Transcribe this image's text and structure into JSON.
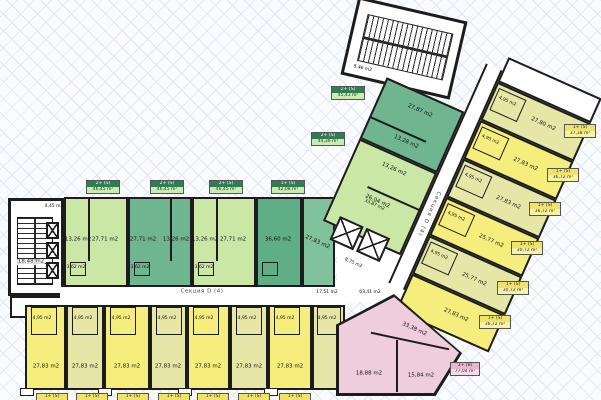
{
  "colors": {
    "wall": "#1c1c1c",
    "green_light": "#cbe7a6",
    "green_medium": "#6fb58f",
    "green_dark": "#5fae85",
    "yellow_bright": "#f6ee7c",
    "yellow_pale": "#e6e7a6",
    "pink": "#eecddc",
    "badge_green": "#2f7d52",
    "badge_yellow": "#efe46a",
    "badge_pink": "#e7b6d1"
  },
  "left_wing": {
    "stair": {
      "area": "18,48 m2",
      "vestibule": "4,45 m2"
    },
    "green_units": [
      {
        "room_a": "13,26 m2",
        "room_b": "27,71 m2",
        "bath": "3,62 m2"
      },
      {
        "room_a": "27,71 m2",
        "room_b": "13,26 m2",
        "bath": "3,62 m2"
      },
      {
        "room_a": "13,26 m2",
        "room_b": "27,71 m2",
        "bath": "3,62 m2"
      },
      {
        "room_a": "36,60 m2"
      },
      {
        "room_a": "27,83 m2"
      }
    ],
    "corridor": {
      "label": "Секция D (4)",
      "area_left": "17,51 m2",
      "area_right": "63,41 m2"
    },
    "yellow_units": [
      {
        "main": "27,83 m2",
        "bath": "4,95 m2"
      },
      {
        "main": "27,83 m2",
        "bath": "4,95 m2"
      },
      {
        "main": "27,83 m2",
        "bath": "4,95 m2"
      },
      {
        "main": "27,83 m2",
        "bath": "4,95 m2"
      },
      {
        "main": "27,83 m2",
        "bath": "4,95 m2"
      },
      {
        "main": "27,83 m2",
        "bath": "4,95 m2"
      },
      {
        "main": "27,83 m2",
        "bath": "4,95 m2"
      },
      {
        "bath": "4,95 m2"
      }
    ]
  },
  "diagonal_wing": {
    "stair_area": "5,46 m2",
    "hall_area": "33,87 m2",
    "lift_area": "8,75 m2",
    "corridor_label": "Секция D (4)",
    "green_units": [
      {
        "room_a": "27,87 m2",
        "room_b": "13,28 m2"
      },
      {
        "room_a": "13,26 m2",
        "room_b": "26,04 m2"
      }
    ],
    "yellow_units": [
      {
        "main": "27,80 m2",
        "bath": "4,95 m2"
      },
      {
        "main": "27,83 m2",
        "bath": "4,95 m2"
      },
      {
        "main": "27,83 m2",
        "bath": "4,95 m2"
      },
      {
        "main": "25,77 m2",
        "bath": "4,95 m2"
      },
      {
        "main": "25,77 m2",
        "bath": "4,95 m2"
      },
      {
        "main": "27,83 m2"
      }
    ],
    "pink_unit": {
      "room_a": "33,38 m2",
      "room_b": "18,88 m2",
      "room_c": "15,84 m2"
    }
  },
  "badges": {
    "top": [
      {
        "type": "2+ (S)",
        "area": "46,45 m²"
      },
      {
        "type": "2+ (S)",
        "area": "46,45 m²"
      },
      {
        "type": "2+ (S)",
        "area": "46,45 m²"
      },
      {
        "type": "1+ (S)",
        "area": "42,08 m²"
      }
    ],
    "left": [
      {
        "type": "2+ (S)",
        "area": "45,43 m²"
      },
      {
        "type": "2+ (S)",
        "area": "44,36 m²"
      }
    ],
    "right": [
      {
        "type": "1+ (S)",
        "area": "37,38 m²"
      },
      {
        "type": "1+ (S)",
        "area": "36,72 m²"
      },
      {
        "type": "1+ (S)",
        "area": "36,72 m²"
      },
      {
        "type": "1+ (S)",
        "area": "30,72 m²"
      },
      {
        "type": "1+ (S)",
        "area": "30,72 m²"
      },
      {
        "type": "1+ (S)",
        "area": "36,72 m²"
      }
    ],
    "pink": {
      "type": "3+ (B)",
      "area": "77,04 m²"
    },
    "bottom": [
      {
        "type": "1+ (S)",
        "area": "36,72 m²"
      },
      {
        "type": "1+ (S)",
        "area": "36,72 m²"
      },
      {
        "type": "1+ (S)",
        "area": "36,72 m²"
      },
      {
        "type": "1+ (S)",
        "area": "36,72 m²"
      },
      {
        "type": "1+ (S)",
        "area": "36,72 m²"
      },
      {
        "type": "1+ (S)",
        "area": "36,72 m²"
      },
      {
        "type": "1+ (S)",
        "area": "36,72 m²"
      }
    ]
  }
}
